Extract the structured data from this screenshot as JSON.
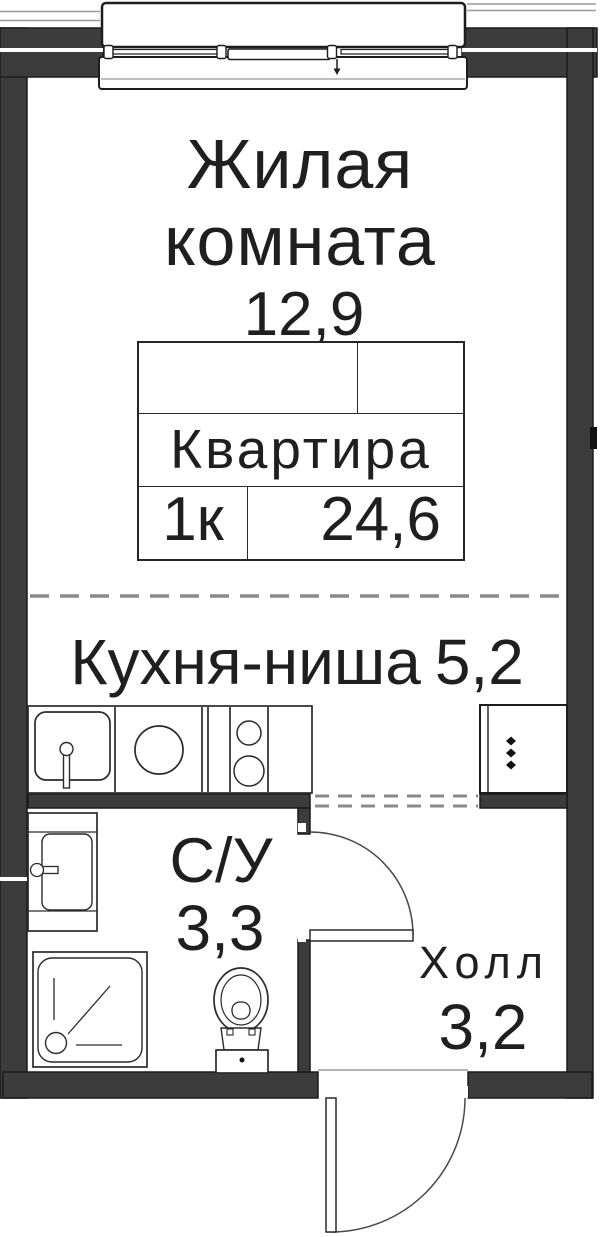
{
  "labels": {
    "living": {
      "name": "Жилая комната",
      "area": "12,9"
    },
    "kitchen": {
      "name": "Кухня-ниша",
      "area": "5,2"
    },
    "bathroom": {
      "name": "С/У",
      "area": "3,3"
    },
    "hall": {
      "name": "Холл",
      "area": "3,2"
    }
  },
  "info_table": {
    "apartment_label": "Квартира",
    "rooms_label": "1к",
    "total_area": "24,6"
  },
  "colors": {
    "wall": "#3c3c3c",
    "outline": "#1d1d1d",
    "dashed": "#8a8a8a",
    "background": "#ffffff",
    "text": "#1f1f1f"
  }
}
